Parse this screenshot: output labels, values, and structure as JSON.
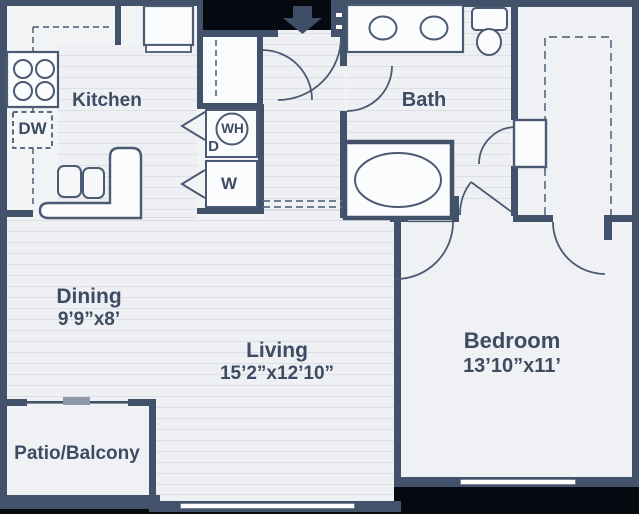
{
  "plan": {
    "title": "One-bedroom apartment floor plan",
    "rooms": {
      "kitchen": {
        "label": "Kitchen"
      },
      "bath": {
        "label": "Bath"
      },
      "dining": {
        "label": "Dining",
        "dimensions": "9’9”x8’"
      },
      "living": {
        "label": "Living",
        "dimensions": "15’2”x12’10”"
      },
      "bedroom": {
        "label": "Bedroom",
        "dimensions": "13’10”x11’"
      },
      "patio": {
        "label": "Patio/Balcony"
      }
    },
    "appliances": {
      "dishwasher": "DW",
      "water_heater": "WH",
      "dryer": "D",
      "washer": "W"
    },
    "colors": {
      "wall": "#42526b",
      "text": "#3d4c63",
      "floor": "#eef0f3",
      "stripe": "#dcdfe5",
      "outside": "#06090f",
      "fixture_fill": "#fbfcfd"
    }
  }
}
